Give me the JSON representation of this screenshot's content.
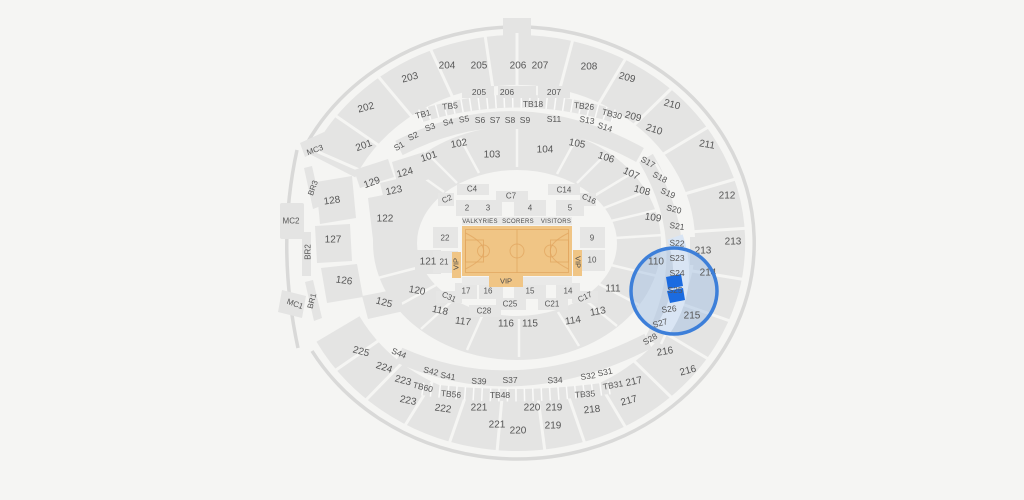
{
  "venue_map": {
    "colors": {
      "background": "#f5f5f3",
      "section_fill": "#e4e4e3",
      "label": "#565656",
      "court_fill": "#f0c585",
      "court_lines": "#e2a660",
      "selection_ring": "#3d7fd9",
      "selection_tint": "#9dbde2",
      "selection_band": "#d9e5f4",
      "selected_section_fill": "#1b6be0"
    },
    "selection": {
      "selected_section": "S25"
    },
    "court": {
      "home_label": "VALKYRIES",
      "scorers_label": "SCORERS",
      "visitors_label": "VISITORS",
      "vip_left": "VIP",
      "vip_right": "VIP",
      "vip_bottom": "VIP"
    },
    "labels": {
      "n201": "201",
      "n202": "202",
      "n203o": "203",
      "n203i": "203",
      "n204": "204",
      "n205o": "205",
      "n205i": "205",
      "n206o": "206",
      "n206i": "206",
      "n207o": "207",
      "n207i": "207",
      "n208": "208",
      "n209o": "209",
      "n209i": "209",
      "n210o": "210",
      "n210i": "210",
      "n211": "211",
      "n212": "212",
      "n213o": "213",
      "n213i": "213",
      "n214": "214",
      "n215": "215",
      "n216i": "216",
      "n216o": "216",
      "n217u": "217",
      "n217l": "217",
      "n218": "218",
      "n219s": "219",
      "n220s": "220",
      "n221s": "221",
      "n222": "222",
      "n223u": "223",
      "n223l": "223",
      "n224": "224",
      "n225": "225",
      "n219b": "219",
      "n220b": "220",
      "n221b": "221",
      "n101": "101",
      "n102": "102",
      "n103": "103",
      "n104": "104",
      "n105": "105",
      "n106": "106",
      "n107": "107",
      "n108": "108",
      "n109": "109",
      "n110": "110",
      "n111": "111",
      "n113": "113",
      "n114": "114",
      "n115": "115",
      "n116": "116",
      "n117": "117",
      "n118": "118",
      "n120": "120",
      "n121": "121",
      "n122": "122",
      "n123": "123",
      "n124": "124",
      "n125": "125",
      "n126": "126",
      "n127": "127",
      "n128": "128",
      "n129": "129",
      "s1": "S1",
      "s2": "S2",
      "s3": "S3",
      "s4": "S4",
      "s5": "S5",
      "s6": "S6",
      "s7": "S7",
      "s8": "S8",
      "s9": "S9",
      "s11": "S11",
      "s13": "S13",
      "s14": "S14",
      "s17": "S17",
      "s18": "S18",
      "s19": "S19",
      "s20": "S20",
      "s21": "S21",
      "s22": "S22",
      "s23": "S23",
      "s24": "S24",
      "s25": "S25",
      "s26": "S26",
      "s27": "S27",
      "s28": "S28",
      "s31": "S31",
      "s32": "S32",
      "s34": "S34",
      "s37": "S37",
      "s39": "S39",
      "s41": "S41",
      "s42": "S42",
      "s44": "S44",
      "tb1": "TB1",
      "tb5": "TB5",
      "tb18": "TB18",
      "tb26": "TB26",
      "tb30": "TB30",
      "tb31": "TB31",
      "tb35": "TB35",
      "tb48": "TB48",
      "tb56": "TB56",
      "tb60": "TB60",
      "c2": "C2",
      "c4": "C4",
      "c7": "C7",
      "c14": "C14",
      "c16": "C16",
      "c17": "C17",
      "c21": "C21",
      "c25": "C25",
      "c28": "C28",
      "c31": "C31",
      "f2": "2",
      "f3": "3",
      "f4": "4",
      "f5": "5",
      "f9": "9",
      "f10": "10",
      "f14": "14",
      "f15": "15",
      "f16": "16",
      "f17": "17",
      "f21": "21",
      "f22": "22",
      "mc1": "MC1",
      "mc2": "MC2",
      "mc3": "MC3",
      "br1": "BR1",
      "br2": "BR2",
      "br3": "BR3"
    }
  }
}
